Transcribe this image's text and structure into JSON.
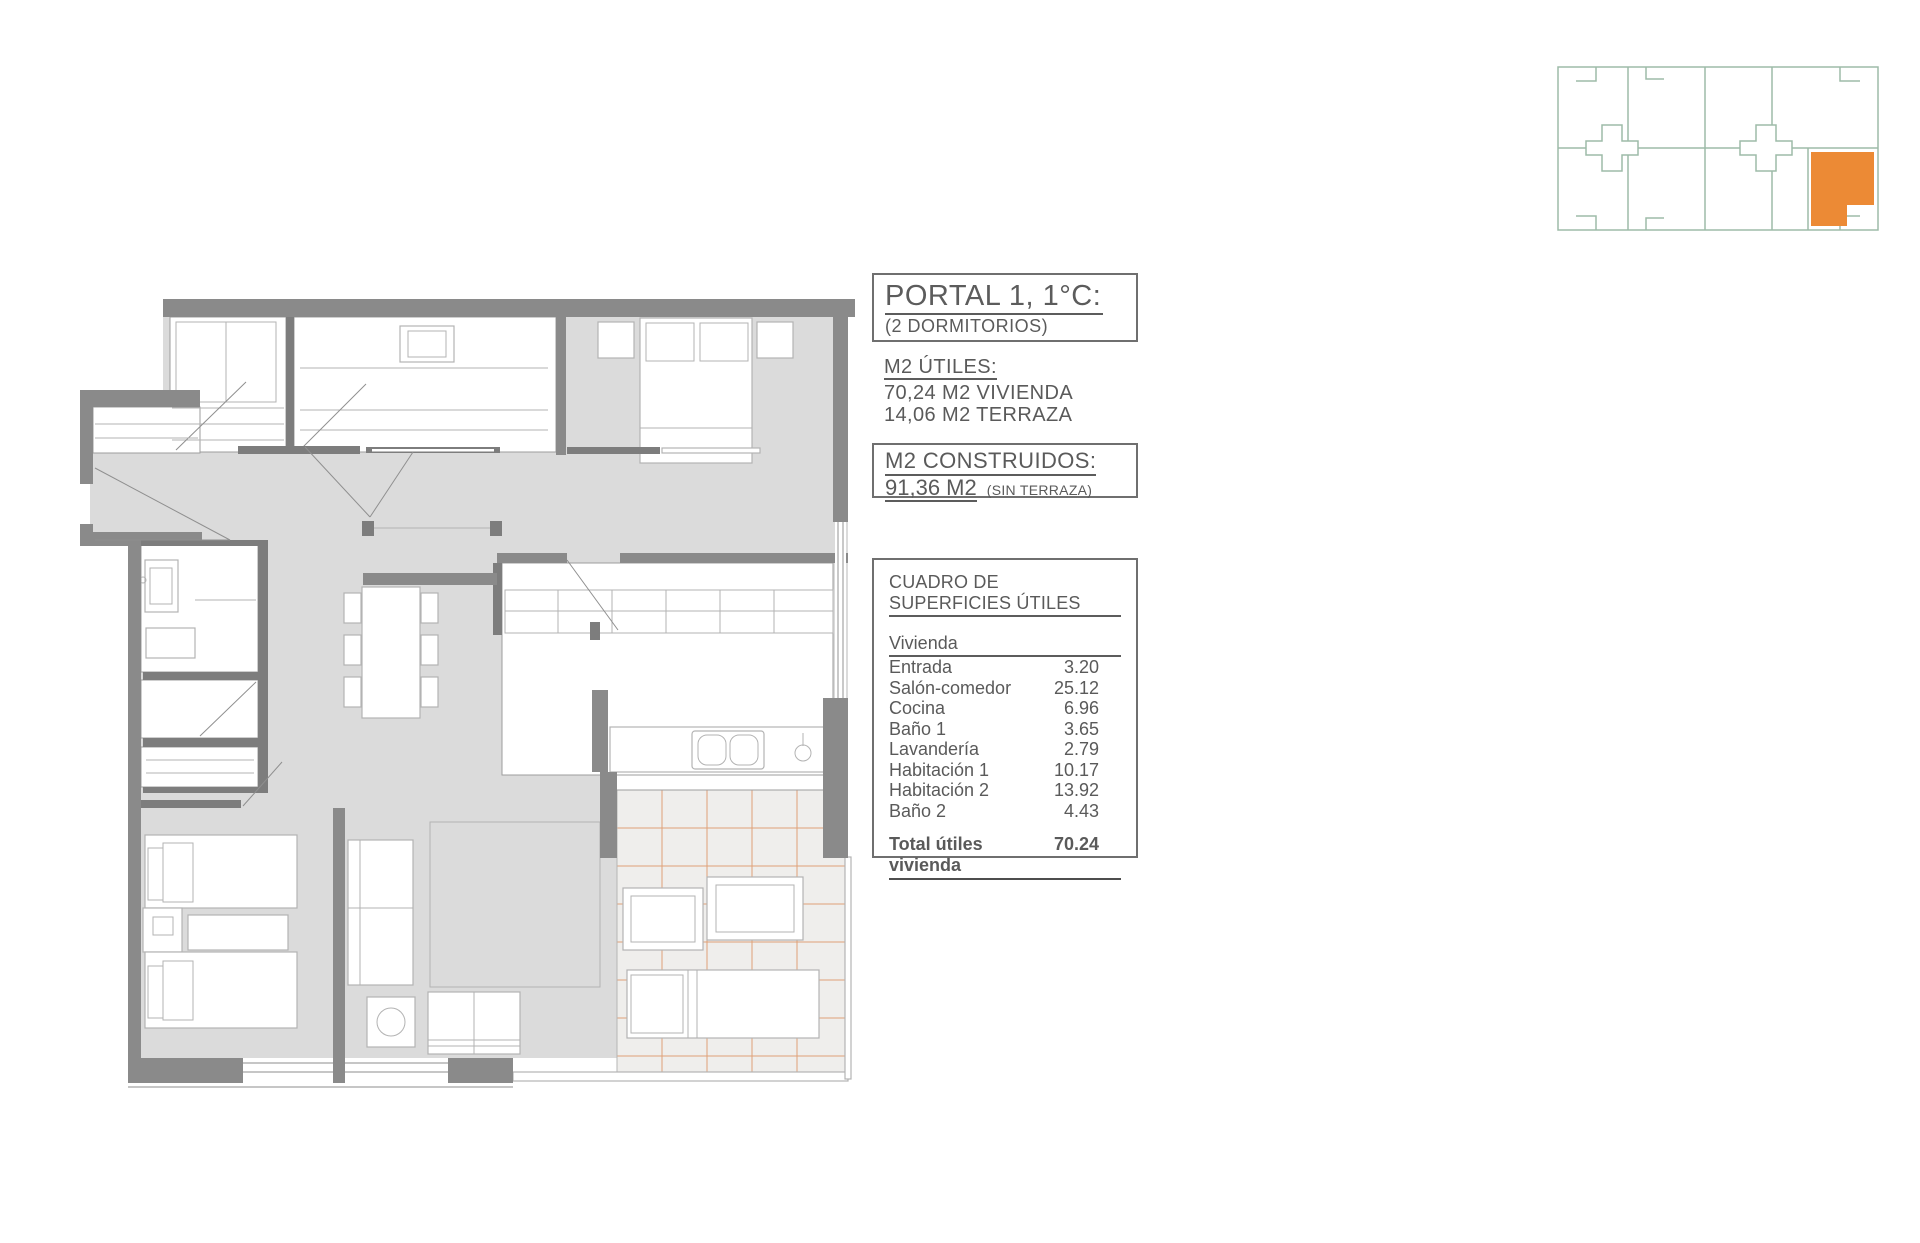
{
  "title_block": {
    "title": "PORTAL 1, 1°C:",
    "subtitle": "(2 DORMITORIOS)"
  },
  "utiles_block": {
    "heading": "M2 ÚTILES:",
    "line1": "70,24 M2 VIVIENDA",
    "line2": "14,06 M2 TERRAZA"
  },
  "construidos_block": {
    "heading": "M2 CONSTRUIDOS:",
    "value": "91,36 M2",
    "note": "(SIN TERRAZA)"
  },
  "surfaces_table": {
    "title": "CUADRO DE SUPERFICIES ÚTILES",
    "section": "Vivienda",
    "rows": [
      {
        "label": "Entrada",
        "value": "3.20"
      },
      {
        "label": "Salón-comedor",
        "value": "25.12"
      },
      {
        "label": "Cocina",
        "value": "6.96"
      },
      {
        "label": "Baño 1",
        "value": "3.65"
      },
      {
        "label": "Lavandería",
        "value": "2.79"
      },
      {
        "label": "Habitación 1",
        "value": "10.17"
      },
      {
        "label": "Habitación 2",
        "value": "13.92"
      },
      {
        "label": "Baño 2",
        "value": "4.43"
      }
    ],
    "total_label": "Total útiles vivienda",
    "total_value": "70.24"
  },
  "colors": {
    "wall": "#8A8A8A",
    "floor": "#DBDBDB",
    "terrace_line": "#DFA077",
    "keyplan_line": "#9DBBA9",
    "accent": "#EC8A35",
    "ink": "#5A5A5A"
  }
}
